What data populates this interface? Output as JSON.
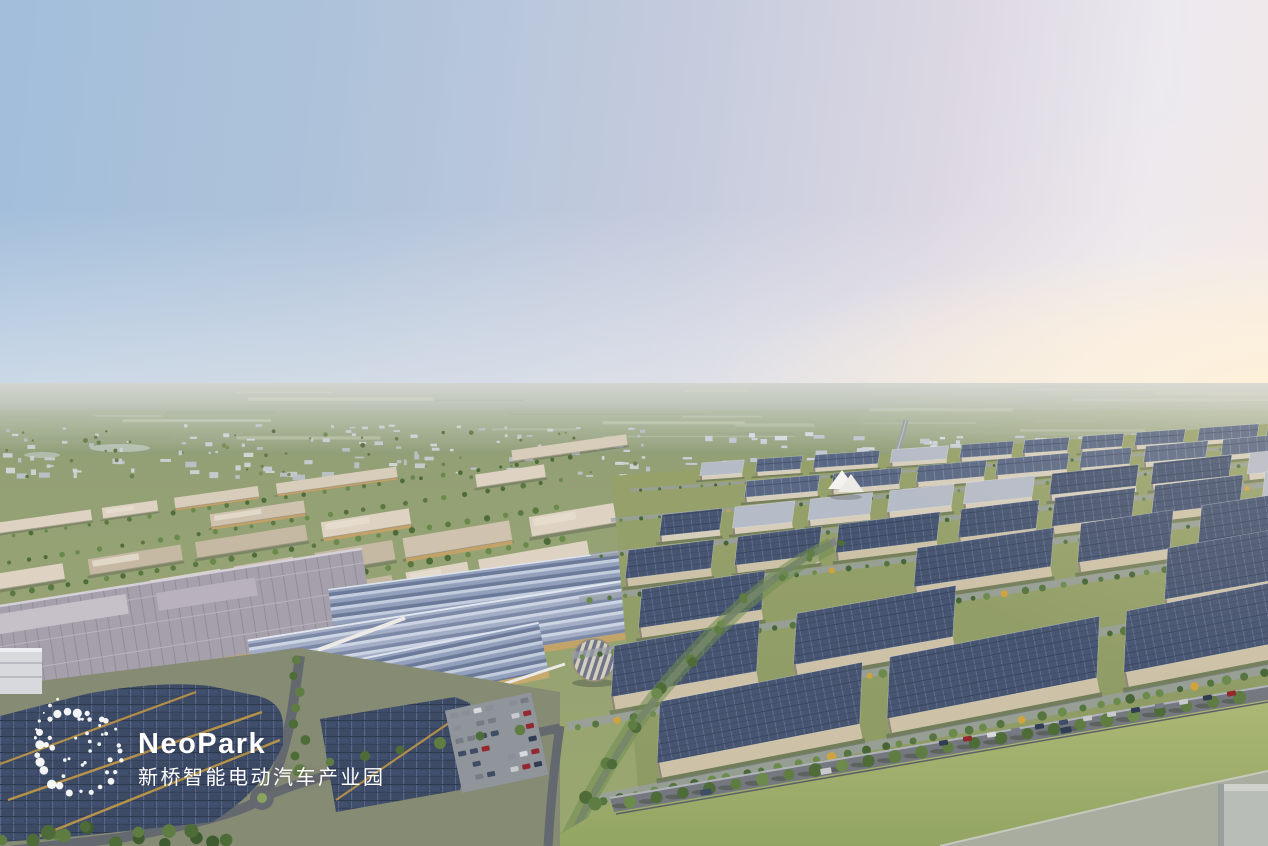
{
  "image": {
    "kind": "aerial-architectural-rendering",
    "subject": "NeoPark smart electric-vehicle industrial park at dusk, aerial bird's-eye view with factories, solar rooftops, residential city in the distance and green fields at the horizon"
  },
  "logo": {
    "brand": "NeoPark",
    "subtitle_cn": "新桥智能电动汽车产业园",
    "mark": "dot-sphere-icon",
    "color": "#ffffff"
  },
  "palette": {
    "sky_top_left": "#a2bedb",
    "sky_top_right": "#ece9ef",
    "sky_horizon_left": "#c6d1de",
    "sky_horizon_right_glow": "#fdf2e4",
    "far_plain": "#9aa58c",
    "field_green": "#8a9a6e",
    "tree_green": "#5d7b42",
    "tree_autumn": "#cfa33e",
    "solar_roof_blue": "#46536e",
    "sawtooth_roof_blue": "#93a0bc",
    "factory_roof_grey": "#a5a0ab",
    "beige_roof": "#d5cab8",
    "gold_wall": "#c9a86a",
    "distant_city_white": "#ced3da",
    "residential_accent_orange": "#b8813d",
    "lawn_foreground": "#9fb06d",
    "road_grey": "#75797f",
    "concrete_slab": "#a9ad9f",
    "logo_white": "#ffffff"
  }
}
